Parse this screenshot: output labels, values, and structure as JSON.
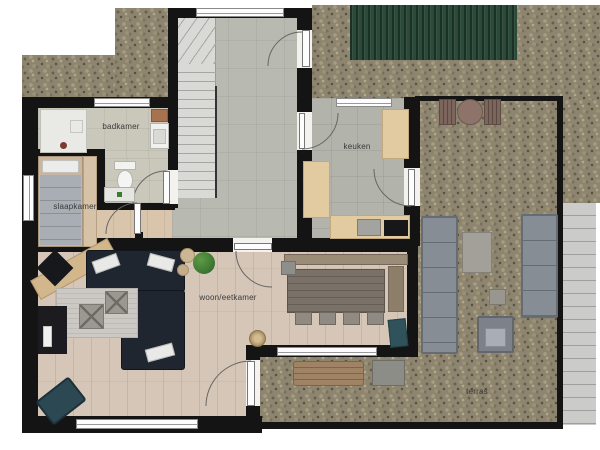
{
  "rooms": [
    {
      "id": "badkamer",
      "label": "badkamer"
    },
    {
      "id": "slaapkamer",
      "label": "slaapkamer"
    },
    {
      "id": "keuken",
      "label": "keuken"
    },
    {
      "id": "woon-eetkamer",
      "label": "woon/eetkamer"
    },
    {
      "id": "terras",
      "label": "terras"
    }
  ],
  "colors": {
    "wall": "#141414",
    "gravel": "#8d8570",
    "hedge_green": "#2c4a3a",
    "decking": "#cbcbc9",
    "hall_tile": "#b8b9b1",
    "kitchen_tile": "#b2b3ab",
    "bathroom_tile": "#cac7bb",
    "bedroom_floor": "#d8c5ab",
    "living_wood_floor": "#d5c6b7",
    "sofa_dark": "#20262f",
    "kitchen_counter": "#e2cba1",
    "outdoor_sofa_gray": "#878d95",
    "accent_chair_teal": "#2c4852",
    "dining_wood": "#7a7268"
  }
}
